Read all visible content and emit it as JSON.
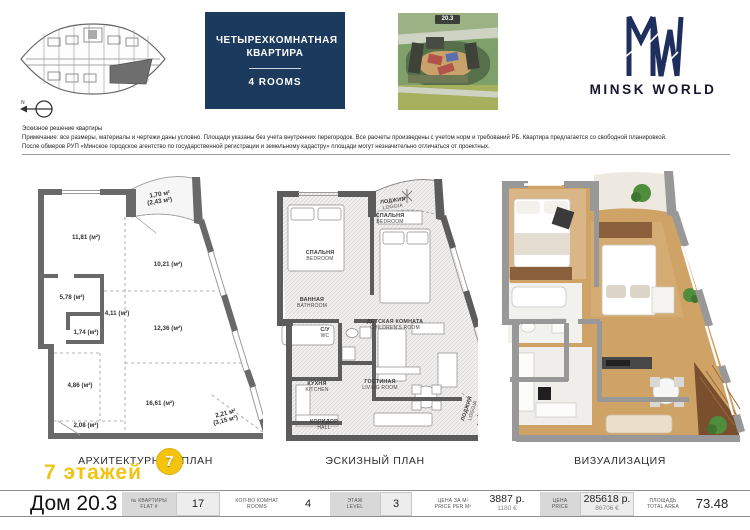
{
  "header": {
    "title_ru": "ЧЕТЫРЕХКОМНАТНАЯ КВАРТИРА",
    "title_en": "4 ROOMS",
    "aerial_badge": "20.3",
    "brand": "MINSK WORLD",
    "north": "N"
  },
  "disclaimer": {
    "line1": "Эскизное решение квартиры",
    "line2": "Примечание: все размеры, материалы и чертежи даны условно. Площади указаны без учета внутренних перегородок. Все расчеты произведены с учетом норм и требований РБ. Квартира предлагается со свободной планировкой.",
    "line3": "После обмеров РУП «Минское городское агентство по государственной регистрации и земельному кадастру» площади могут незначительно отличаться от проектных."
  },
  "arch_plan": {
    "label": "АРХИТЕКТУРНЫЙ ПЛАН",
    "floors_stamp": "7 этажей",
    "badge": "7",
    "areas": {
      "loggia_top": "1,70 м²",
      "loggia_top_alt": "(2,43 м²)",
      "room1": "11,81 (м²)",
      "room2": "10,21 (м²)",
      "room3": "5,78 (м²)",
      "corridor": "4,11 (м²)",
      "wc": "1,74 (м²)",
      "room4": "12,36 (м²)",
      "kitchen_zone": "4,86 (м²)",
      "living": "16,61 (м²)",
      "entry": "2,08 (м²)",
      "loggia_bottom": "2,21 м²",
      "loggia_bottom_alt": "(3,15 м²)"
    }
  },
  "sketch_plan": {
    "label": "ЭСКИЗНЫЙ ПЛАН",
    "rooms": {
      "bedroom1": {
        "ru": "СПАЛЬНЯ",
        "en": "BEDROOM"
      },
      "loggia_top": {
        "ru": "ЛОДЖИЯ",
        "en": "LOGGIA"
      },
      "bedroom2": {
        "ru": "СПАЛЬНЯ",
        "en": "BEDROOM"
      },
      "bathroom": {
        "ru": "ВАННАЯ",
        "en": "BATHROOM"
      },
      "wc": {
        "ru": "С/У",
        "en": "WC"
      },
      "children": {
        "ru": "ДЕТСКАЯ КОМНАТА",
        "en": "CHILDREN'S ROOM"
      },
      "kitchen": {
        "ru": "КУХНЯ",
        "en": "KITCHEN"
      },
      "living": {
        "ru": "ГОСТИНАЯ",
        "en": "LIVING ROOM"
      },
      "hall": {
        "ru": "КОРИДОР",
        "en": "HALL"
      },
      "loggia_bottom": {
        "ru": "ЛОДЖИЯ",
        "en": "LOGGIA"
      }
    }
  },
  "viz_plan": {
    "label": "ВИЗУАЛИЗАЦИЯ"
  },
  "footer": {
    "house": "Дом 20.3",
    "flat": {
      "label_ru": "№ КВАРТИРЫ",
      "label_en": "FLAT #",
      "value": "17"
    },
    "rooms": {
      "label_ru": "КОЛ-ВО КОМНАТ",
      "label_en": "ROOMS",
      "value": "4"
    },
    "level": {
      "label_ru": "ЭТАЖ",
      "label_en": "LEVEL",
      "value": "3"
    },
    "price_m2": {
      "label_ru": "ЦЕНА ЗА М²",
      "label_en": "PRICE PER M²",
      "value_byn": "3887 р.",
      "value_eur": "1180 €"
    },
    "price": {
      "label_ru": "ЦЕНА",
      "label_en": "PRICE",
      "value_byn": "285618 р.",
      "value_eur": "86706 €"
    },
    "area": {
      "label_ru": "ПЛОЩАДЬ",
      "label_en": "TOTAL AREA",
      "value": "73.48"
    }
  },
  "colors": {
    "brand_navy": "#1b3a5e",
    "stamp_yellow": "#f2c30f",
    "wall_gray": "#696969"
  }
}
